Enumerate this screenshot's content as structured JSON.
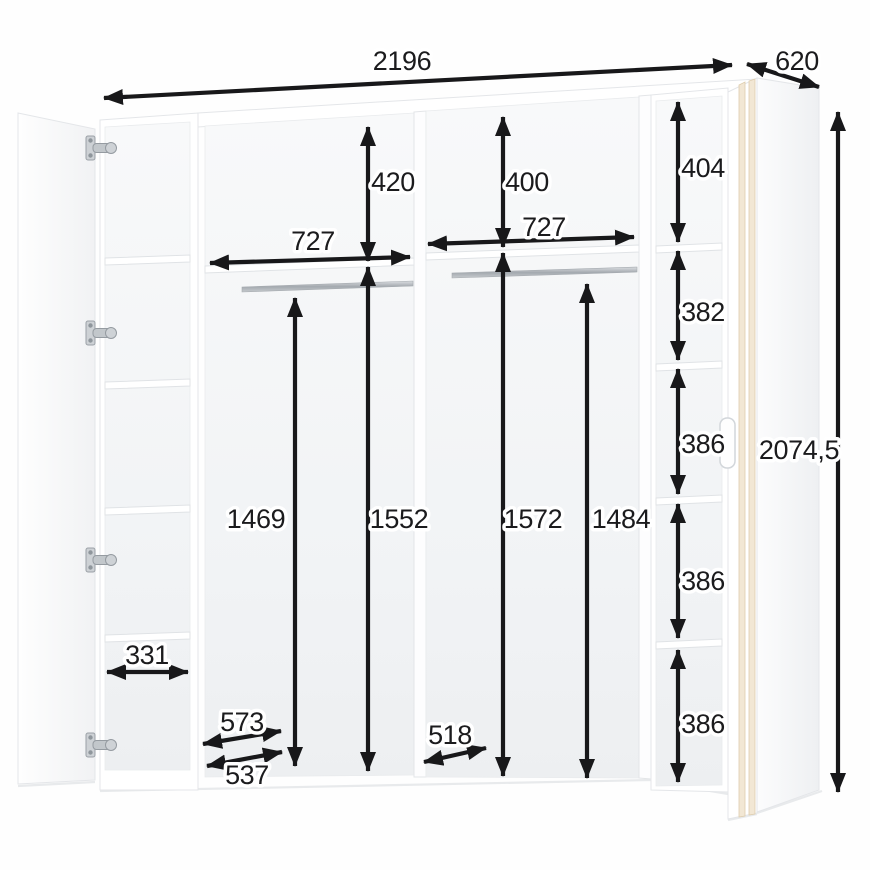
{
  "diagram": {
    "type": "wardrobe-interior-dimension-drawing",
    "dims": {
      "total_width": "2196",
      "total_depth": "620",
      "total_height": "2074,5",
      "comp1_top_height": "420",
      "comp1_width": "727",
      "comp1_rail_height": "1469",
      "comp1_inner_height": "1552",
      "comp2_top_height": "400",
      "comp2_width": "727",
      "comp2_inner_height": "1572",
      "comp2_rail_height": "1484",
      "side_cubby_1": "404",
      "side_cubby_2": "382",
      "side_cubby_3": "386",
      "side_cubby_4": "386",
      "side_cubby_5": "386",
      "left_shelf_width": "331",
      "depth_upper_shelf": "573",
      "depth_lower_shelf": "537",
      "depth_mid_shelf": "518"
    },
    "colors": {
      "dimension_ink": "#18181a",
      "door_edge_wood": "#f2e7d4",
      "panel_white": "#ffffff",
      "hinge_metal": "#c2c7cb"
    }
  }
}
